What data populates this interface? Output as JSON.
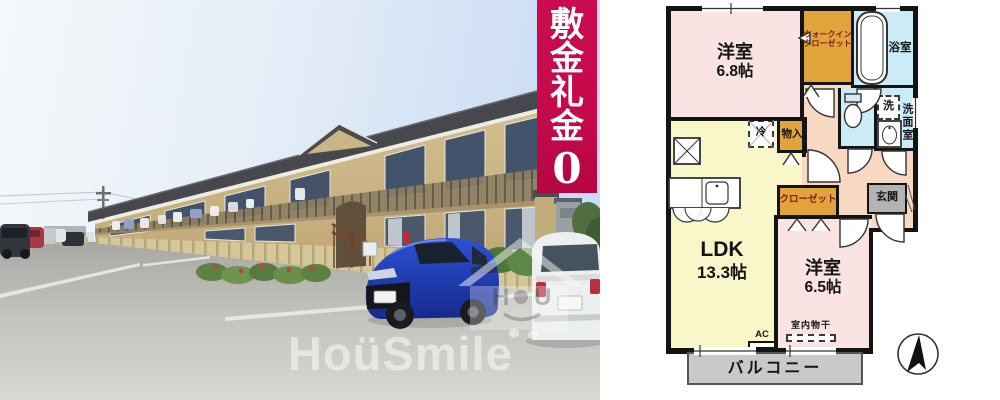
{
  "photo": {
    "watermark_text": "HoüSmile",
    "logo": {
      "letter_left": "H",
      "letter_right": "U"
    }
  },
  "banner": {
    "chars": [
      "敷",
      "金",
      "礼",
      "金"
    ],
    "zero": "0",
    "bg_color": "#c40a4a"
  },
  "floorplan": {
    "bedroom_a": {
      "name": "洋室",
      "area": "6.8帖"
    },
    "walkin_closet": {
      "line1": "ウォークイン",
      "line2": "クローゼット"
    },
    "bath": {
      "label": "浴室"
    },
    "washer": {
      "label": "洗"
    },
    "washroom": {
      "label": "洗面室"
    },
    "fridge": {
      "label": "冷"
    },
    "storage": {
      "label": "物入"
    },
    "closet": {
      "label": "クローゼット"
    },
    "entrance": {
      "label": "玄関"
    },
    "ldk": {
      "name": "LDK",
      "area": "13.3帖"
    },
    "bedroom_b": {
      "name": "洋室",
      "area": "6.5帖"
    },
    "indoor_drying": {
      "label": "室内物干"
    },
    "ac": {
      "label": "AC"
    },
    "balcony": {
      "label": "バルコニー"
    },
    "colors": {
      "room_pink": "#f9e3e3",
      "ldk_yellow": "#f9f7c9",
      "closet_orange": "#e2a33c",
      "wet_cyan": "#cbecf6",
      "hall_peach": "#f7d8c2",
      "entrance_gray": "#b3b3b3",
      "balcony_gray": "#c9c9c9",
      "wall_black": "#141414",
      "closet_text_maroon": "#7b1d12"
    }
  }
}
